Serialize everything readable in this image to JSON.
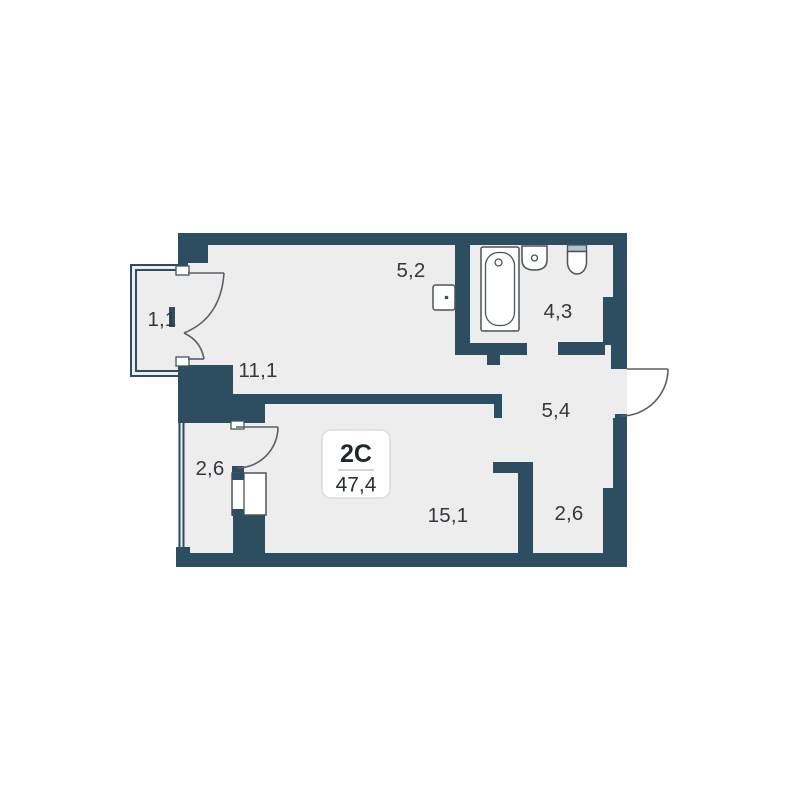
{
  "unit": {
    "label": "2C",
    "area": "47,4"
  },
  "rooms": [
    {
      "name": "balcony",
      "area": "1,1"
    },
    {
      "name": "kitchen-living",
      "area": "11,1"
    },
    {
      "name": "kitchen-niche",
      "area": "5,2"
    },
    {
      "name": "bathroom",
      "area": "4,3"
    },
    {
      "name": "hallway",
      "area": "5,4"
    },
    {
      "name": "loggia",
      "area": "2,6"
    },
    {
      "name": "living-room",
      "area": "15,1"
    },
    {
      "name": "wardrobe-nook",
      "area": "2,6"
    }
  ],
  "fixtures": [
    "bathtub-icon",
    "sink-icon",
    "toilet-icon",
    "washing-machine-icon",
    "wardrobe-icon"
  ],
  "colors": {
    "wall": "#2d4d60",
    "floor": "#ededee",
    "background": "#ffffff",
    "fixture_outline": "#49545b",
    "door_line": "#5a6066",
    "label_text": "#34383c"
  }
}
